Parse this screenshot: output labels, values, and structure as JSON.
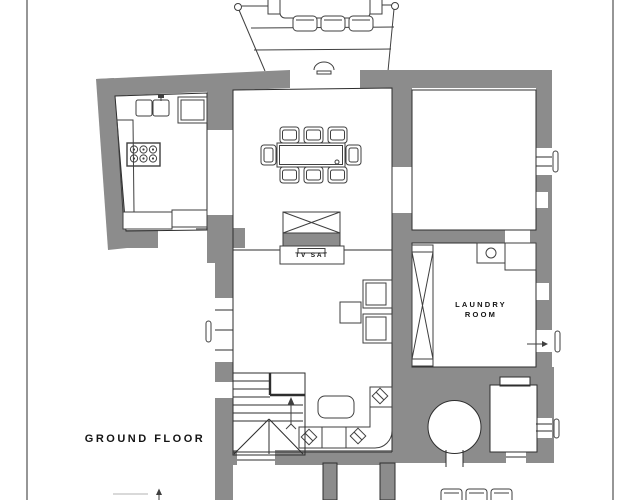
{
  "plan": {
    "labels": {
      "title": "GROUND FLOOR",
      "tv_sat": "TV SAT",
      "laundry_line1": "LAUNDRY",
      "laundry_line2": "ROOM"
    },
    "colors": {
      "wall": "#8c8c8c",
      "line": "#2e2e2e",
      "text": "#141414",
      "background": "#ffffff"
    },
    "symbols": [
      "terrace-table-icon",
      "terrace-chair-icon",
      "kitchen-sink-icon",
      "stove-burners-icon",
      "dining-table-icon",
      "dining-chair-icon",
      "tv-cabinet-icon",
      "wardrobe-x-icon",
      "laundry-sink-icon",
      "armchair-icon",
      "coffee-table-icon",
      "corner-sofa-icon",
      "staircase-up-arrow-icon",
      "bread-oven-icon",
      "entrance-arrow-icon",
      "door-leaf-icon",
      "window-icon"
    ]
  }
}
